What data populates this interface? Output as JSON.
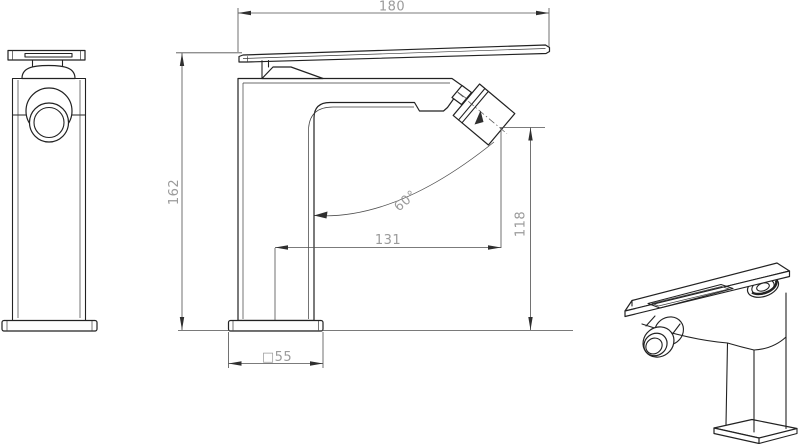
{
  "drawing": {
    "kind": "faucet technical drawing",
    "dims": {
      "width": "180",
      "height": "162",
      "reach": "131",
      "outlet_height": "118",
      "angle": "60°",
      "base": "□55"
    },
    "colors": {
      "background": "#ffffff",
      "object_line": "#222222",
      "dim_line": "#4f4f4f",
      "dim_text": "#9b9b9b"
    }
  }
}
